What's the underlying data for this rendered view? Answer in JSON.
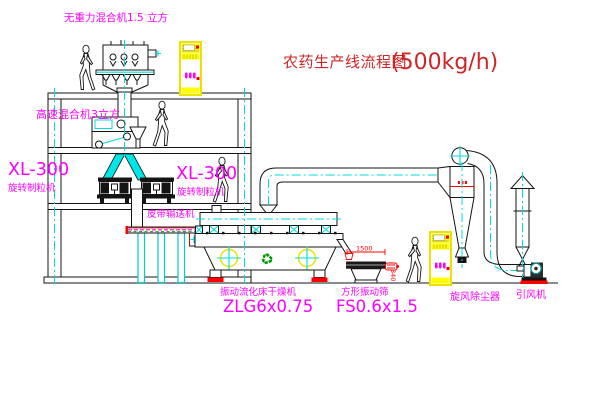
{
  "title": {
    "name_zh": "农药生产线流程图",
    "capacity": "(500kg/h)"
  },
  "equipment_labels": {
    "gravity_free_mixer": "无重力混合机1.5 立方",
    "high_speed_mixer": "高速混合机3立方",
    "granulator_left_model": "XL-300",
    "granulator_left_name": "旋转制粒机",
    "granulator_right_model": "XL-300",
    "granulator_right_name": "旋转制粒机",
    "belt_conveyor": "皮带输送机",
    "fluid_bed_dryer_name": "振动流化床干燥机",
    "fluid_bed_dryer_model": "ZLG6x0.75",
    "square_sieve_name": "方形振动筛",
    "square_sieve_model": "FS0.6x1.5",
    "cyclone": "旋风除尘器",
    "induced_draft_fan": "引风机"
  },
  "dimensions": {
    "sieve_length": "1500",
    "sieve_discharge_height": "340"
  },
  "icons": {
    "recycle": "♻"
  },
  "colors": {
    "label_magenta": "#ff00ff",
    "title_red": "#cc2626",
    "centerline_cyan": "#00dcdc",
    "cabinet_yellow": "#ffff00",
    "accent_red": "#ff0000",
    "recycle_green": "#009900",
    "line_black": "#141414"
  }
}
